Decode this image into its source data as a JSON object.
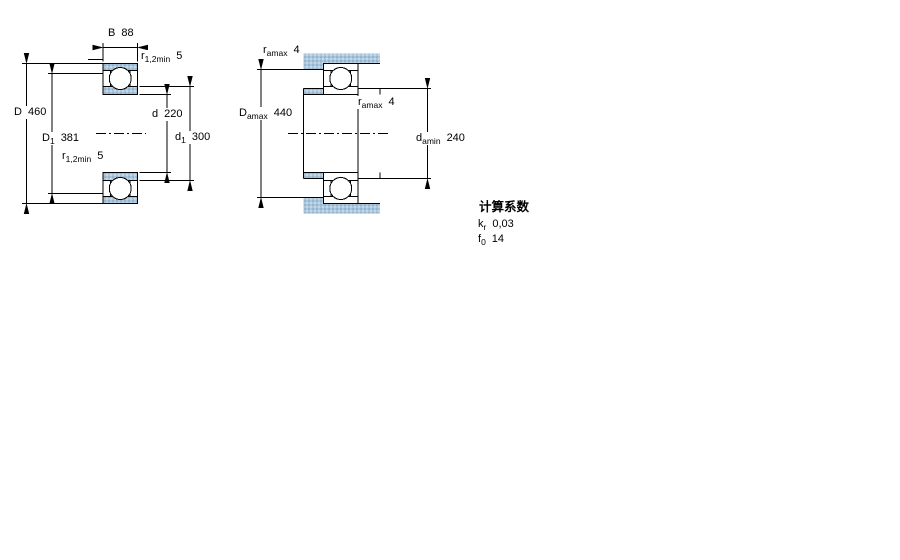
{
  "drawing": {
    "type": "deep-groove-ball-bearing-cross-section-and-abutment-diagram",
    "left_diagram": {
      "dims": {
        "B": {
          "main": "B",
          "value": "88"
        },
        "r_top": {
          "main": "r",
          "sub": "1,2min",
          "value": "5"
        },
        "D": {
          "main": "D",
          "value": "460"
        },
        "D1": {
          "main": "D",
          "sub": "1",
          "value": "381"
        },
        "r_bottom": {
          "main": "r",
          "sub": "1,2min",
          "value": "5"
        },
        "d": {
          "main": "d",
          "value": "220"
        },
        "d1": {
          "main": "d",
          "sub": "1",
          "value": "300"
        }
      }
    },
    "right_diagram": {
      "dims": {
        "r_a_top": {
          "main": "r",
          "sub": "amax",
          "value": "4"
        },
        "D_a": {
          "main": "D",
          "sub": "amax",
          "value": "440"
        },
        "r_a_mid": {
          "main": "r",
          "sub": "amax",
          "value": "4"
        },
        "d_a": {
          "main": "d",
          "sub": "amin",
          "value": "240"
        }
      }
    }
  },
  "factors": {
    "title": "计算系数",
    "kr": {
      "main": "k",
      "sub": "r",
      "value": "0,03"
    },
    "f0": {
      "main": "f",
      "sub": "0",
      "value": "14"
    }
  },
  "colors": {
    "bearing_fill": "#a9c6dc",
    "fill_dot_dark": "#7f9fbe",
    "fill_dot_light": "#e9f1f7",
    "line": "#000000",
    "background": "#ffffff"
  }
}
